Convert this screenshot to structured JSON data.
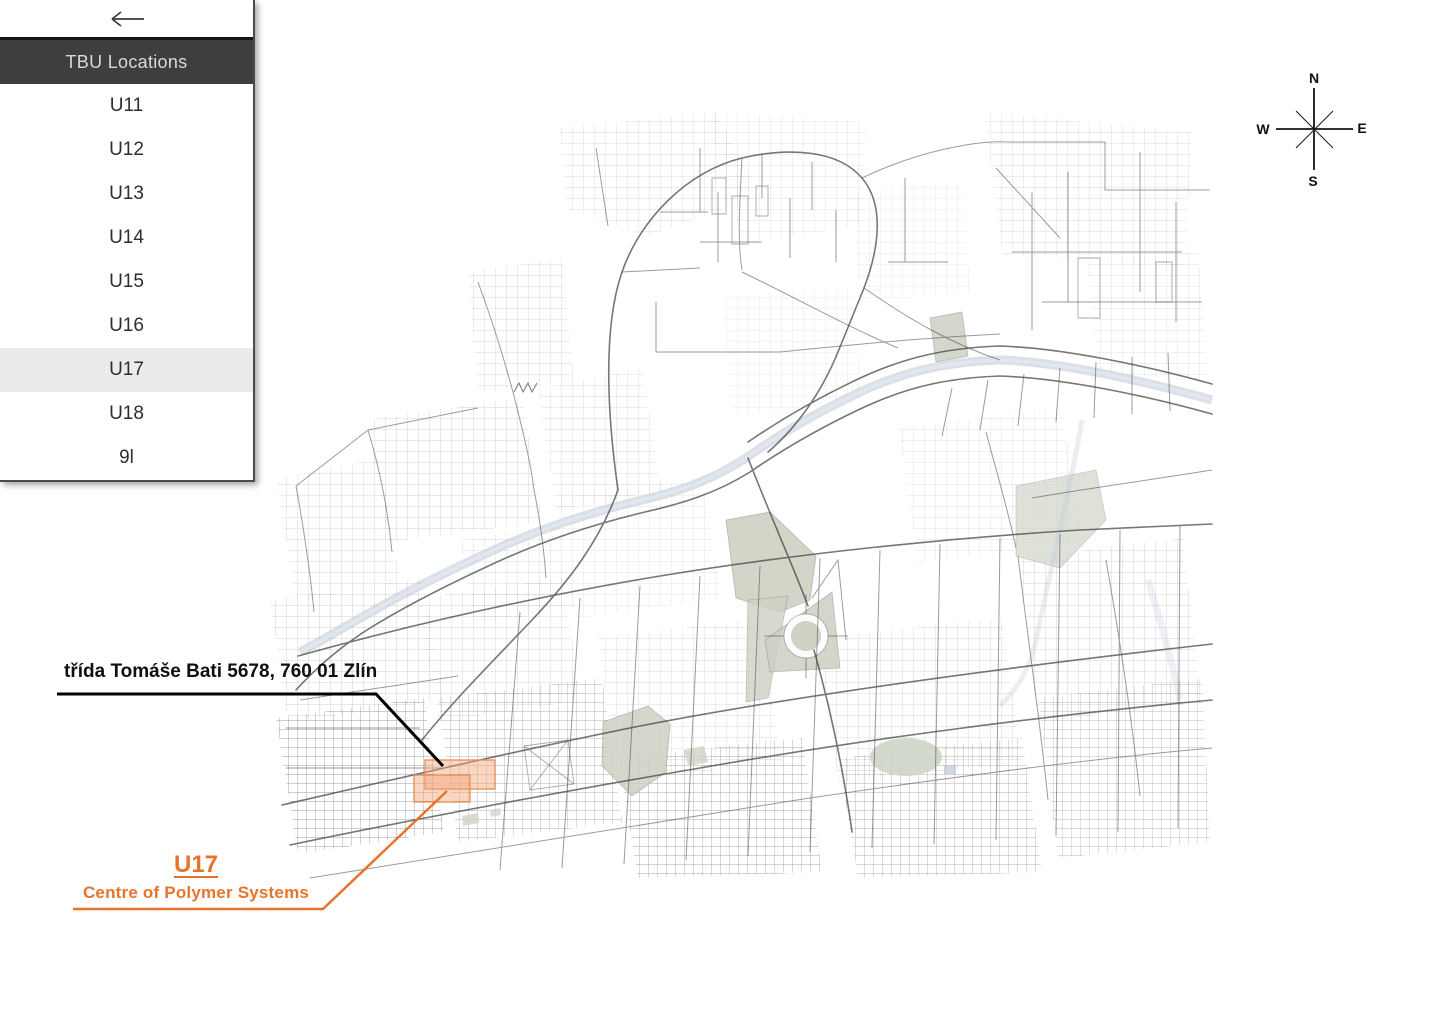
{
  "sidebar": {
    "title": "TBU Locations",
    "items": [
      {
        "label": "U11",
        "selected": false
      },
      {
        "label": "U12",
        "selected": false
      },
      {
        "label": "U13",
        "selected": false
      },
      {
        "label": "U14",
        "selected": false
      },
      {
        "label": "U15",
        "selected": false
      },
      {
        "label": "U16",
        "selected": false
      },
      {
        "label": "U17",
        "selected": true
      },
      {
        "label": "U18",
        "selected": false
      },
      {
        "label": "9l",
        "selected": false
      }
    ]
  },
  "annotation": {
    "address": "třída Tomáše Bati 5678, 760 01 Zlín",
    "building_code": "U17",
    "building_name": "Centre of Polymer Systems"
  },
  "compass": {
    "north": "N",
    "east": "E",
    "south": "S",
    "west": "W"
  },
  "colors": {
    "accent_orange": "#E8732C",
    "highlight_fill": "#F2A478",
    "highlight_border": "#E78A50",
    "sidebar_header_bg": "#3E3E3E",
    "selected_row_bg": "#EBEBEB",
    "river_blue": "#BCC5D6",
    "park_green": "#CDD2C4",
    "street_gray": "#4A4A4A"
  }
}
